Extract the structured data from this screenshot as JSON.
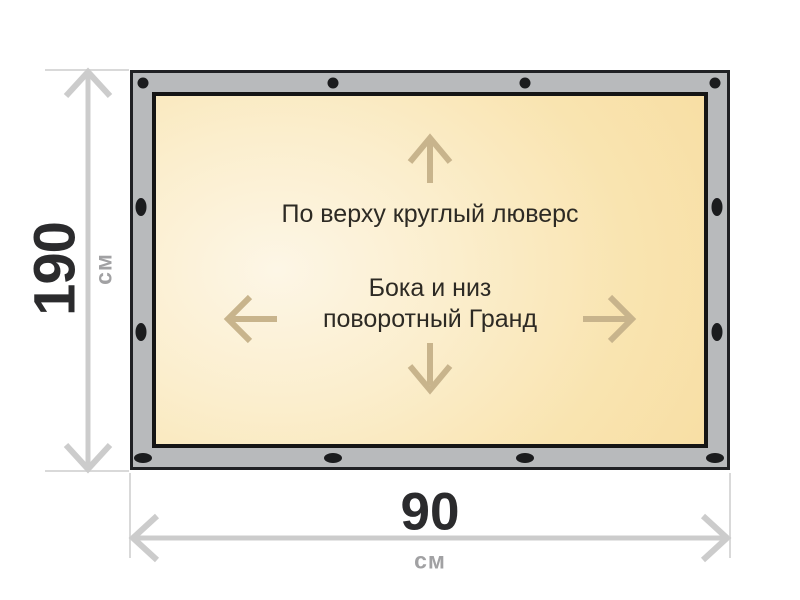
{
  "banner": {
    "annotation_top": "По верху круглый люверс",
    "annotation_center": [
      "Бока и низ",
      "поворотный Гранд"
    ]
  },
  "dimensions": {
    "height": {
      "value": "190",
      "unit": "см"
    },
    "width": {
      "value": "90",
      "unit": "см"
    }
  },
  "colors": {
    "frame_fill": "#b8babc",
    "frame_border": "#202124",
    "panel_border": "#151515",
    "panel_fill_light": "#fdf6e6",
    "panel_fill_dark": "#f8dda1",
    "grommet": "#1b1c1e",
    "direction_arrow": "#c8b48c",
    "dimension_line": "#cccccc",
    "extension_line": "#d9d9d9",
    "value_text": "#2b2b2d",
    "unit_text": "#a1a1a3",
    "annotation_text": "#2d2a24"
  },
  "icons": {
    "grommet_round": "black filled circle (top edge fasteners)",
    "grommet_oval": "black filled oval (side and bottom fasteners)",
    "arrow_up": "tan up arrow",
    "arrow_down": "tan down arrow",
    "arrow_left": "tan left arrow",
    "arrow_right": "tan right arrow",
    "dimension_arrow_vertical": "gray double-headed height arrow",
    "dimension_arrow_horizontal": "gray double-headed width arrow"
  }
}
